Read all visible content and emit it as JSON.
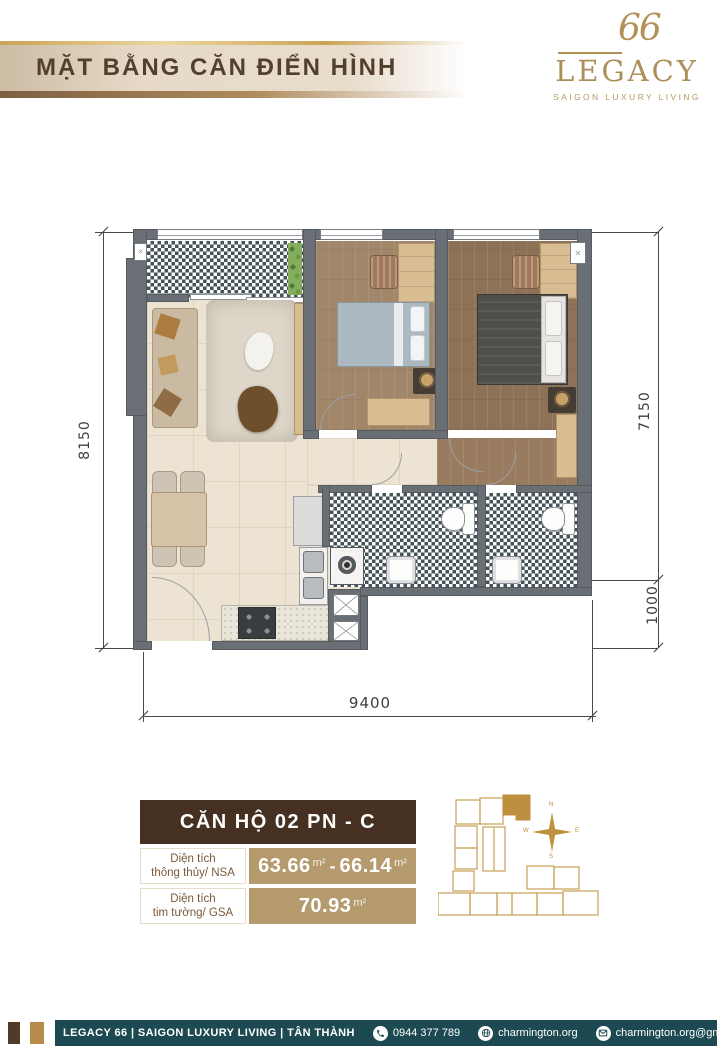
{
  "header": {
    "title": "MẶT BẰNG CĂN ĐIỂN HÌNH"
  },
  "logo": {
    "number": "66",
    "brand": "LEGACY",
    "tagline": "SAIGON LUXURY LIVING"
  },
  "floor_plan": {
    "dimensions": {
      "left": "8150",
      "right_upper": "7150",
      "right_lower": "1000",
      "bottom": "9400"
    }
  },
  "unit_info": {
    "title": "CĂN HỘ 02 PN - C",
    "rows": [
      {
        "label_line1": "Diện tích",
        "label_line2": "thông thủy/ NSA",
        "value1": "63.66",
        "unit1": "m²",
        "separator": "-",
        "value2": "66.14",
        "unit2": "m²"
      },
      {
        "label_line1": "Diện tích",
        "label_line2": "tim tường/ GSA",
        "value1": "70.93",
        "unit1": "m²"
      }
    ]
  },
  "key_plan": {
    "compass": {
      "n": "N",
      "e": "E",
      "s": "S",
      "w": "W"
    }
  },
  "footer": {
    "project": "LEGACY 66 | SAIGON LUXURY LIVING | TÂN THÀNH",
    "phone": "0944 377 789",
    "website": "charmington.org",
    "email": "charmington.org@gmail.com",
    "city": "TP.HCM"
  },
  "colors": {
    "accent_gold": "#b29156",
    "header_brown": "#453021",
    "table_tan": "#b59a6e",
    "footer_teal": "#1d4a52",
    "keyplan_highlight": "#bd8f3e",
    "wall_gray": "#6a6f76"
  }
}
